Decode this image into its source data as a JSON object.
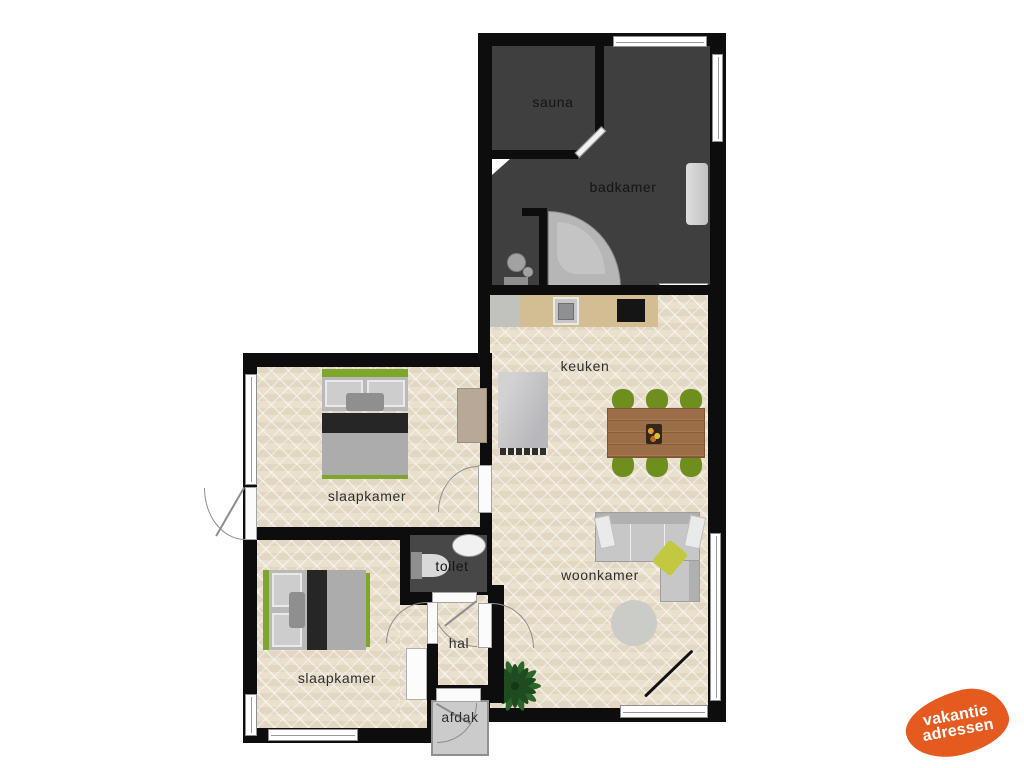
{
  "plan": {
    "title": "vacation-home-floorplan",
    "rooms": [
      {
        "id": "sauna",
        "label": "sauna"
      },
      {
        "id": "badkamer",
        "label": "badkamer"
      },
      {
        "id": "keuken",
        "label": "keuken"
      },
      {
        "id": "slaapkamer-top",
        "label": "slaapkamer"
      },
      {
        "id": "woonkamer",
        "label": "woonkamer"
      },
      {
        "id": "toilet",
        "label": "toilet"
      },
      {
        "id": "hal",
        "label": "hal"
      },
      {
        "id": "slaapkamer-bottom",
        "label": "slaapkamer"
      },
      {
        "id": "afdak",
        "label": "afdak"
      }
    ]
  },
  "logo": {
    "line1": "vakantie",
    "line2": "adressen"
  },
  "colors": {
    "wall": "#0d0d0d",
    "floor_light": "#e9e0cd",
    "floor_dark": "#3f3f3f",
    "toilet_floor": "#474747",
    "accent": "#e55a1e",
    "chair_green": "#6e8e1e",
    "table_brown": "#9c6e47",
    "bed_green": "#7fa62c",
    "counter_tan": "#d3bd93",
    "sofa_gray": "#c7c7c7"
  }
}
